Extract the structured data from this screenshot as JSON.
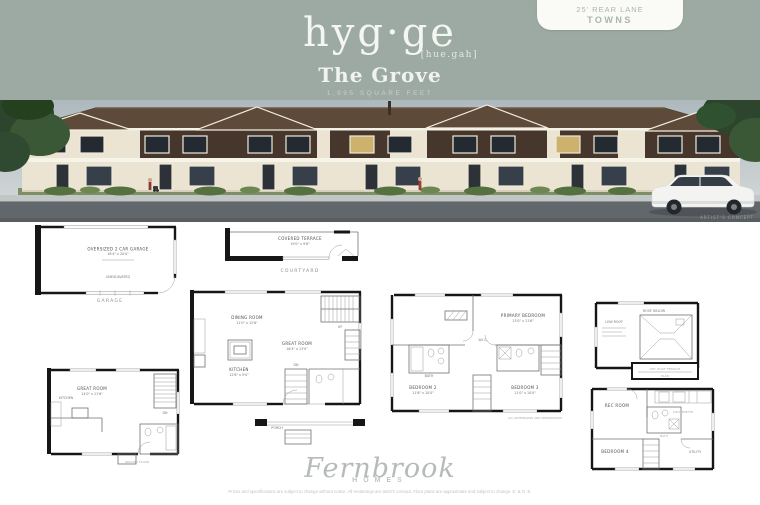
{
  "colors": {
    "header_band": "#9caaa3",
    "badge_bg": "#fafaf7",
    "badge_text": "#a9b6ae",
    "roof": "#5d4a39",
    "wall": "#ece4d2",
    "accent": "#47362b",
    "road": "#62676b"
  },
  "header": {
    "logo": "hyg·ge",
    "pronunciation": "[hue.gah]",
    "plan_name": "The Grove",
    "sqft": "1,995 SQUARE FEET",
    "badge": {
      "line1": "25' REAR LANE",
      "line2": "TOWNS"
    }
  },
  "rendering": {
    "watermark": "ARTIST'S CONCEPT"
  },
  "plans": {
    "garage": {
      "line1": "OVERSIZED 2 CAR GARAGE",
      "line2": "18'4\" x 20'0\"",
      "note": "UNEXCAVATED",
      "caption": "GARAGE"
    },
    "courtyard": {
      "line1": "COVERED TERRACE",
      "line2": "19'0\" x 9'6\"",
      "caption": "COURTYARD"
    },
    "ground": {
      "great": "GREAT ROOM",
      "great_dims": "14'0\" x 11'6\"",
      "kitchen": "KITCHEN",
      "dn": "DN",
      "caption": "GROUND FLOOR"
    },
    "main": {
      "dining": "DINING ROOM",
      "dining_dims": "11'0\" x 12'6\"",
      "great": "GREAT ROOM",
      "great_dims": "16'4\" x 13'0\"",
      "kitchen": "KITCHEN",
      "kitchen_dims": "12'6\" x 9'0\"",
      "up": "UP",
      "dn": "DN",
      "porch": "PORCH"
    },
    "second": {
      "primary": "PRIMARY BEDROOM",
      "primary_dims": "13'0\" x 11'6\"",
      "bed2": "BEDROOM 2",
      "bed2_dims": "11'6\" x 10'0\"",
      "bed3": "BEDROOM 3",
      "bed3_dims": "11'0\" x 10'0\"",
      "wic": "W.I.C.",
      "bath": "BATH",
      "note": "ALL DIMENSIONS ARE APPROXIMATE"
    },
    "roof": {
      "low": "LOW ROOF",
      "below": "ROOF BELOW",
      "box1": "OPT. ROOF TERRACE",
      "box2": "PLAN"
    },
    "basement": {
      "rec": "REC ROOM",
      "kitchenette": "KITCHENETTE",
      "bath": "BATH",
      "bed": "BEDROOM 4",
      "utility": "UTILITY"
    }
  },
  "footer": {
    "brand": "Fernbrook",
    "brand_sub": "HOMES",
    "disclaimer": "Prices and specifications are subject to change without notice. All renderings are artist's concept. Floor plans are approximate and subject to change. E. & O. E."
  }
}
